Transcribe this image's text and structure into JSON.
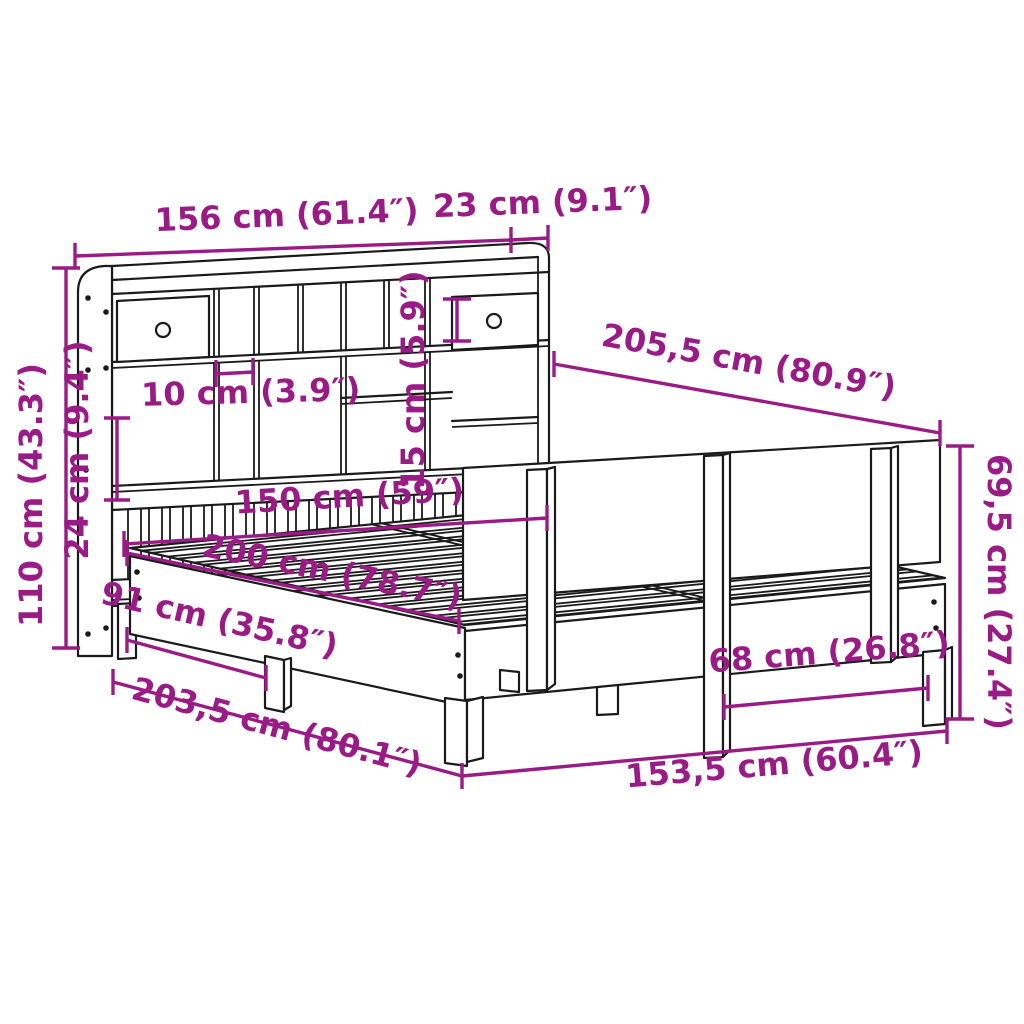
{
  "diagram": {
    "kind": "furniture dimension drawing",
    "subject": "bookcase bed with headboard storage and side panel",
    "colors": {
      "dimension_accent": "#9a1b86",
      "line_art": "#1a1a1a",
      "background": "#ffffff"
    },
    "dimensions": {
      "headboard_width": "156 cm (61.4″)",
      "shelf_depth": "23 cm (9.1″)",
      "total_length_top": "205,5 cm (80.9″)",
      "headboard_height": "110 cm (43.3″)",
      "slat_panel_height": "24 cm (9.4″)",
      "compartment_height": "15 cm (5.9″)",
      "compartment_width": "10 cm (3.9″)",
      "mattress_width": "150 cm (59″)",
      "mattress_length": "200 cm (78.7″)",
      "leg_spacing": "91 cm (35.8″)",
      "base_length": "203,5 cm (80.1″)",
      "foot_width": "153,5 cm (60.4″)",
      "post_spacing": "68 cm (26.8″)",
      "side_panel_height": "69,5 cm (27.4″)"
    }
  }
}
